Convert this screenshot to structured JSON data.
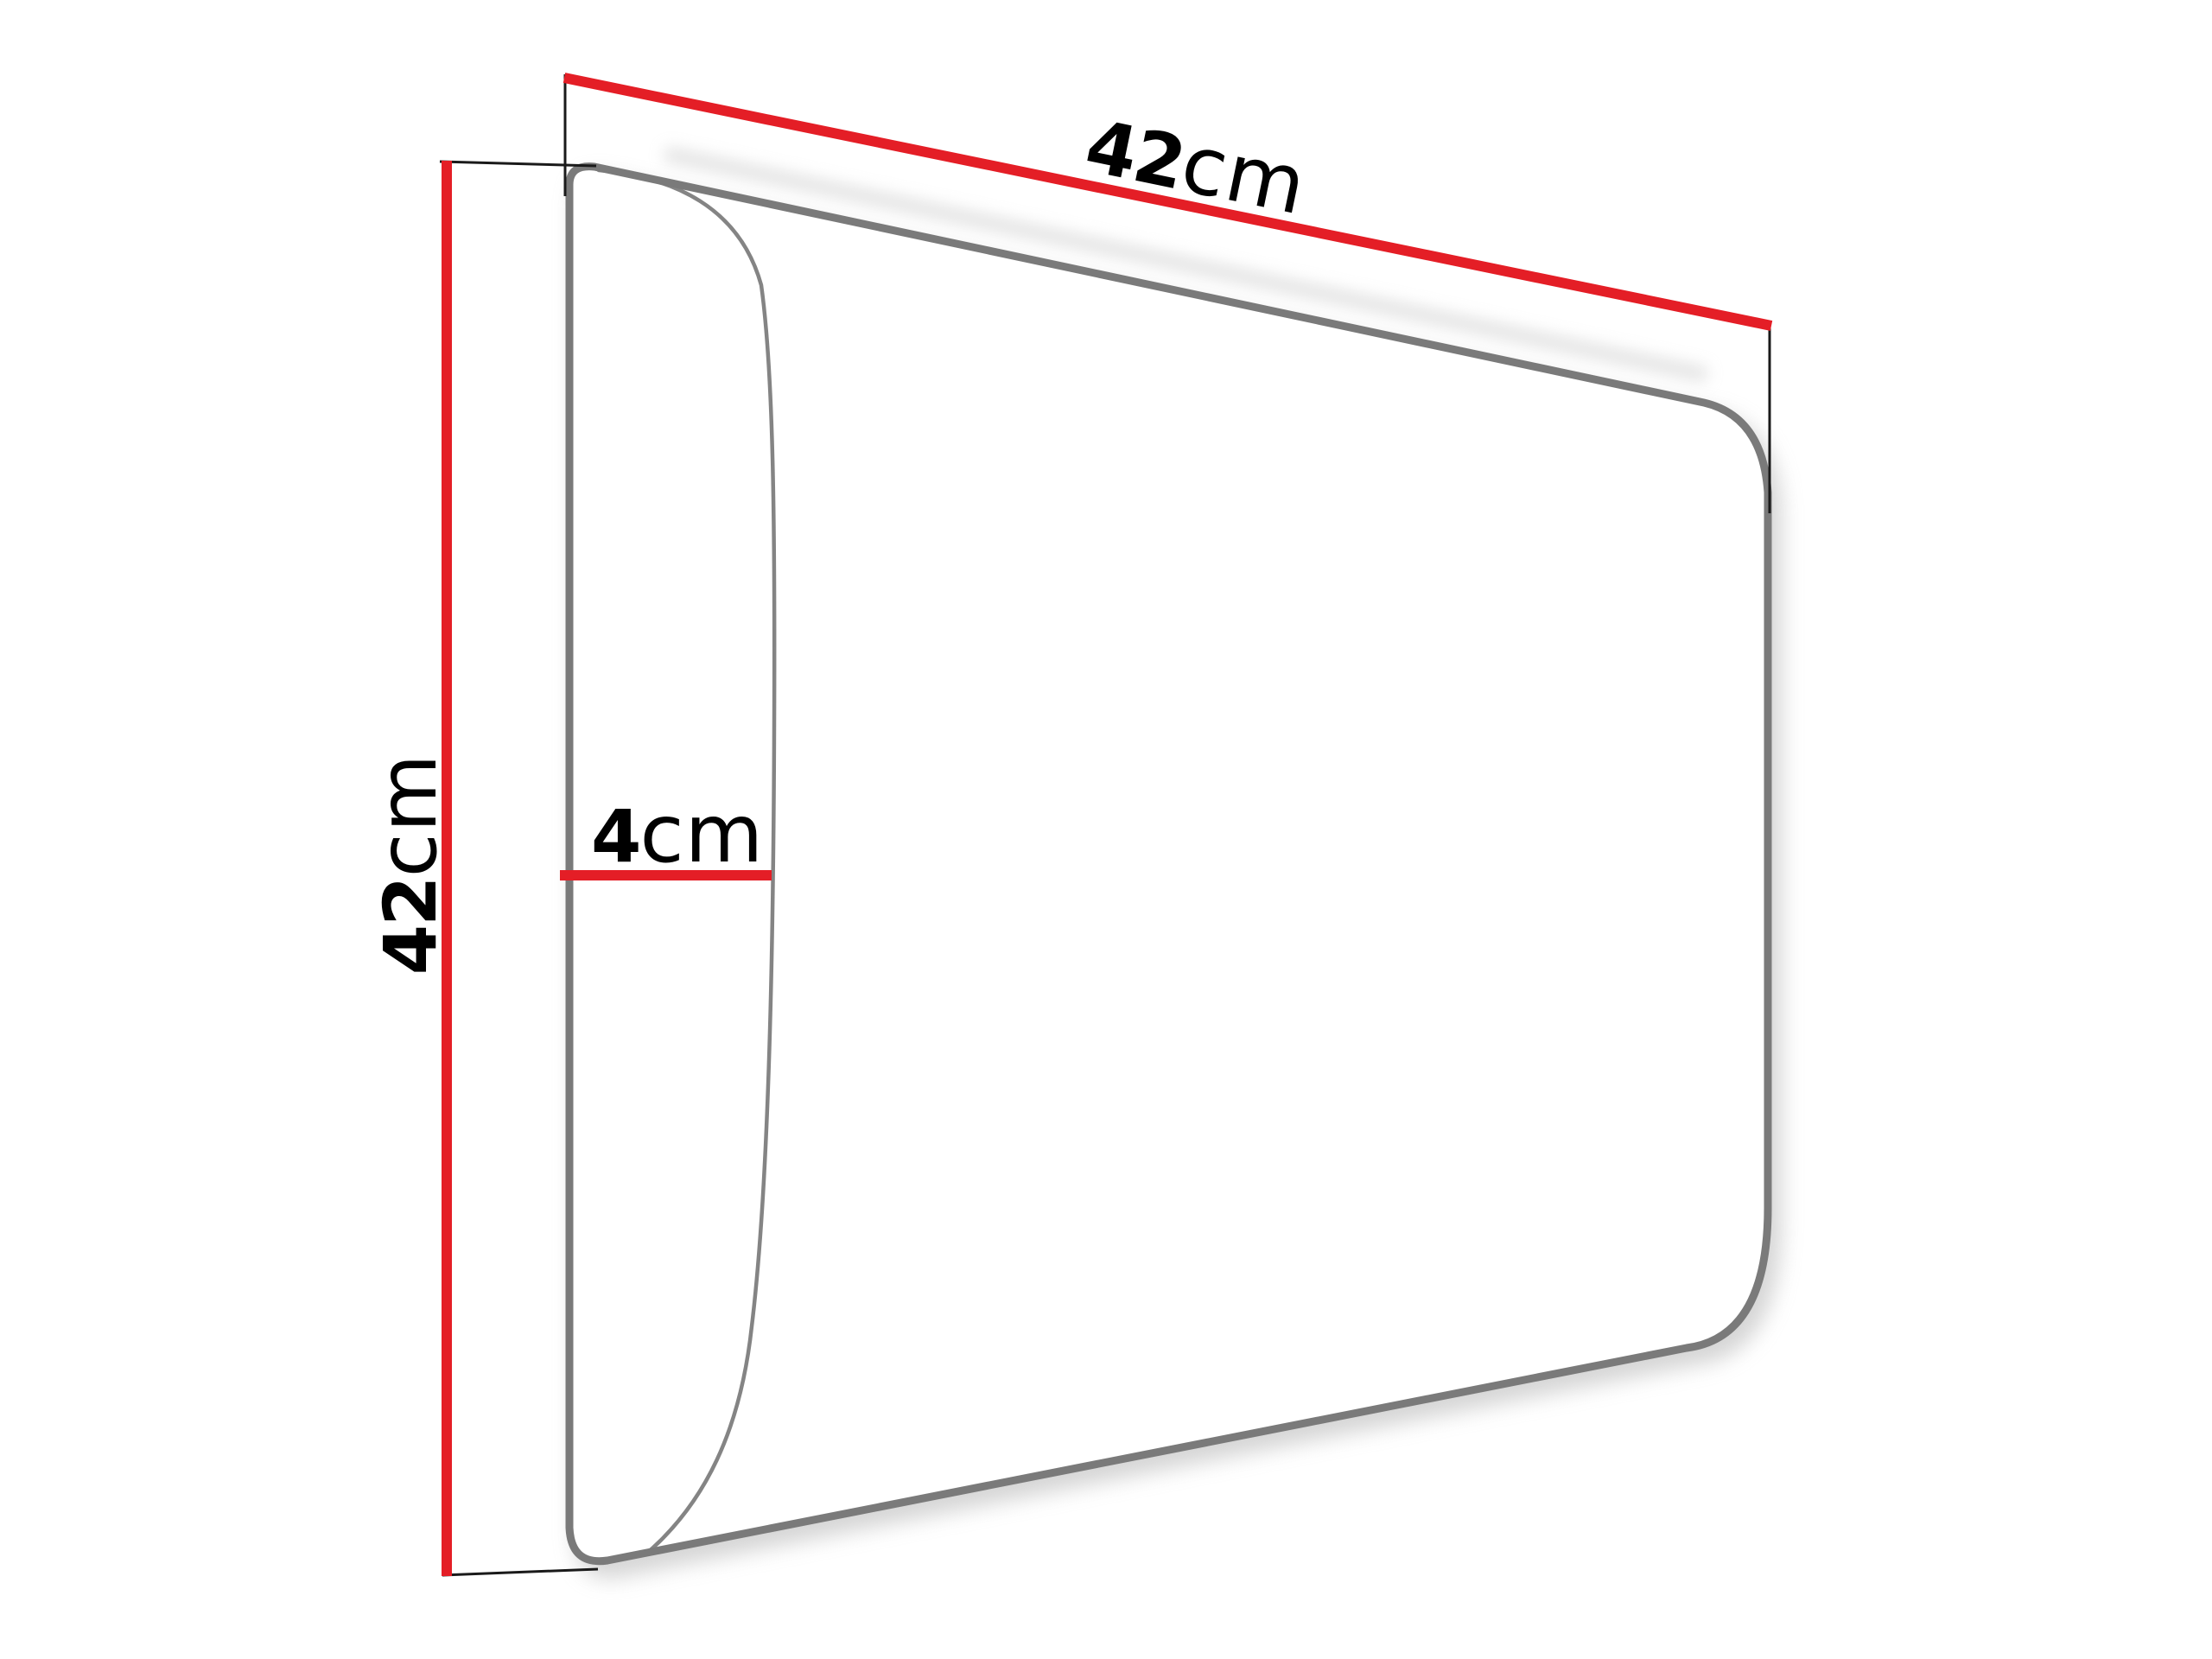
{
  "diagram": {
    "title": "Upholstered wall panel dimension diagram",
    "labels": {
      "width": {
        "value": "42",
        "unit": "cm"
      },
      "height": {
        "value": "42",
        "unit": "cm"
      },
      "depth": {
        "value": "4",
        "unit": "cm"
      }
    },
    "colors": {
      "dimension": "#e41e26",
      "outline": "#7a7a7a",
      "extension": "#1a1a1a",
      "text": "#000000",
      "background": "#ffffff"
    }
  }
}
